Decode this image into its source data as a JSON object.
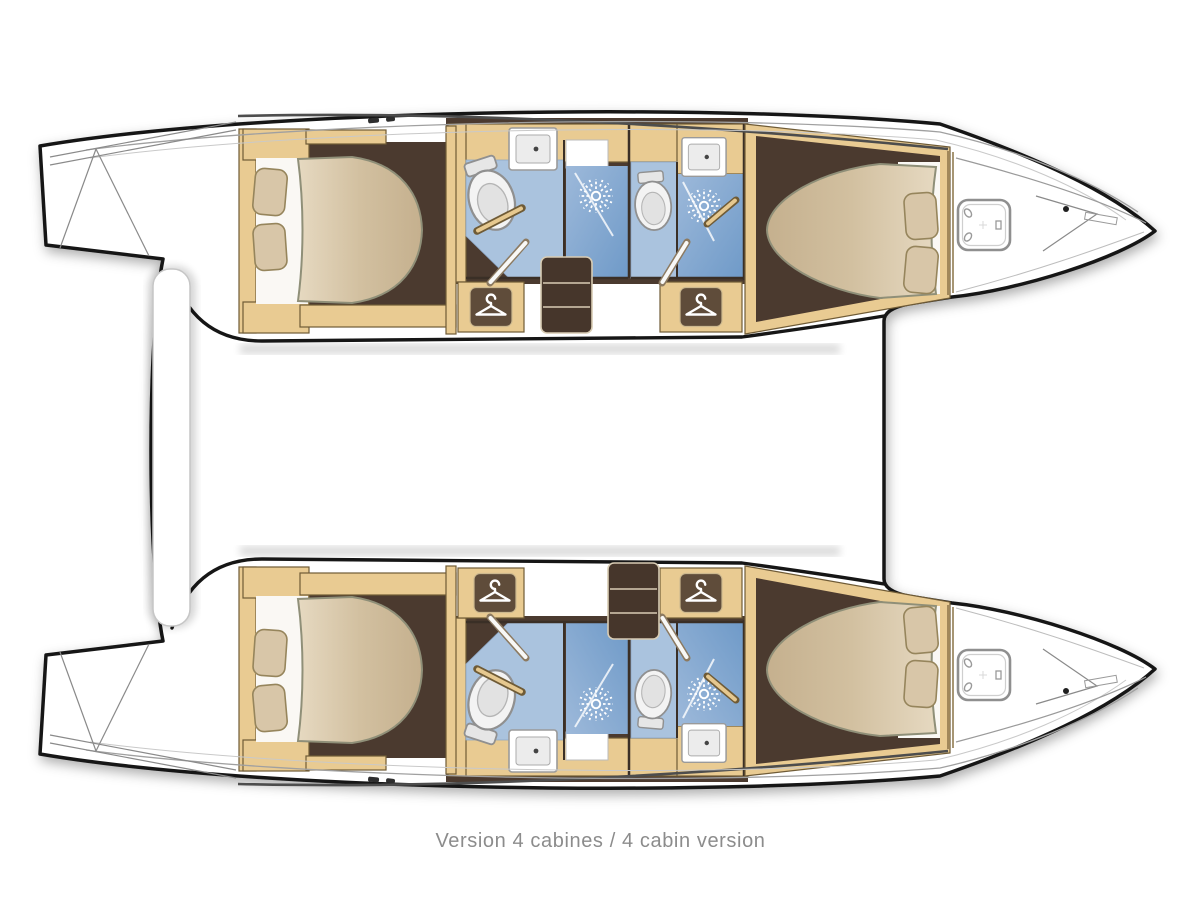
{
  "diagram": {
    "caption": "Version 4 cabines / 4 cabin version",
    "plan_type": "catamaran deck plan, top view, 4-cabin layout",
    "colors": {
      "hull_outline": "#161616",
      "deck_white": "#ffffff",
      "wood": "#e9cb92",
      "wood_border": "#6f5b36",
      "floor_brown": "#4b3a2f",
      "bed_beige": "#d2c0a0",
      "pillow": "#d8c6a8",
      "bath_blue": "#aac3de",
      "shower_blue": "#7fa6cf",
      "fixture_grey": "#f0f0f0",
      "caption_grey": "#8c8c8c"
    },
    "hulls": [
      {
        "name": "upper hull",
        "rooms": [
          "aft double cabin with two pillows",
          "aft bathroom with toilet and washbasin",
          "aft shower",
          "wardrobe with hanger",
          "companionway stairs",
          "fore bathroom with toilet and washbasin",
          "fore shower",
          "wardrobe with hanger",
          "fore double cabin with two pillows",
          "bow locker with deck hatch",
          "stern swim platform"
        ]
      },
      {
        "name": "lower hull",
        "rooms": [
          "aft double cabin with two pillows",
          "aft bathroom with toilet and washbasin",
          "aft shower",
          "wardrobe with hanger",
          "companionway stairs",
          "fore bathroom with toilet and washbasin",
          "fore shower",
          "wardrobe with hanger",
          "fore double cabin with two pillows",
          "bow locker with deck hatch",
          "stern swim platform"
        ]
      }
    ],
    "between_hulls": {
      "aft_feature": "aft deck bench"
    }
  }
}
